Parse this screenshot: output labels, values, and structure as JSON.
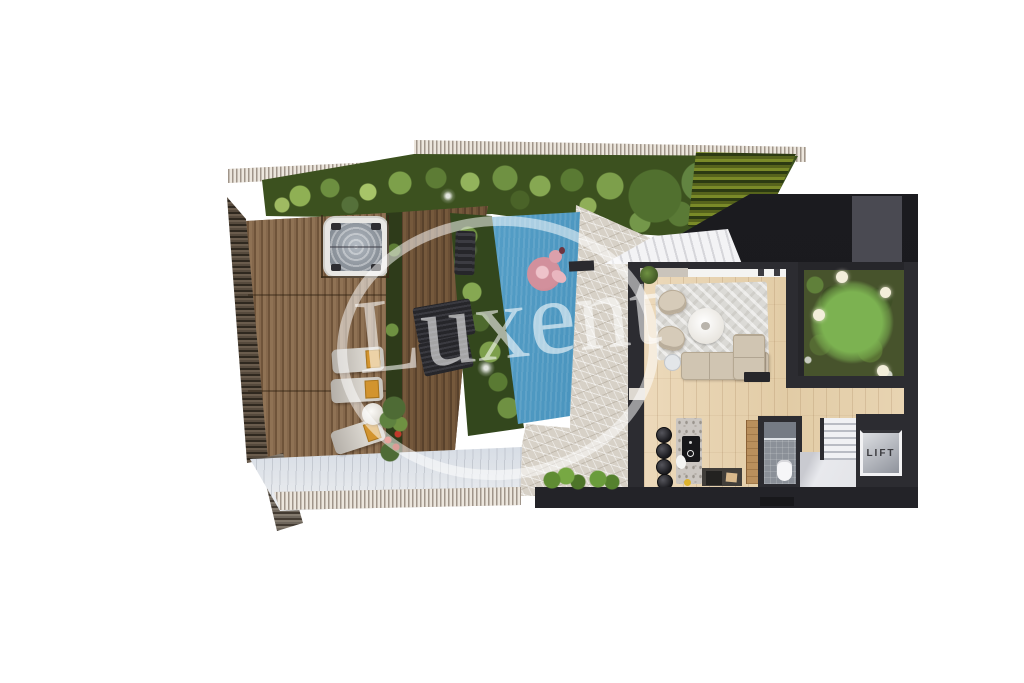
{
  "watermark": {
    "text": "Luxent"
  },
  "rooms": {
    "lift": {
      "label": "LIFT"
    }
  },
  "palette": {
    "background": "#ffffff",
    "roof_dark": "#1b1b1f",
    "wall_dark": "#2c2c31",
    "deck_wood": "#7b5f43",
    "interior_wood": "#e6d2b0",
    "stone_paving": "#d7d1c7",
    "pool_water": "#529fc9",
    "greenery": "#5f8140",
    "atrium_moss": "#47532c",
    "flamingo_pink": "#d2909c",
    "towel_orange": "#d2942f",
    "lounger_gray": "#c9c5be",
    "fence_beige": "#e6dfd6"
  }
}
